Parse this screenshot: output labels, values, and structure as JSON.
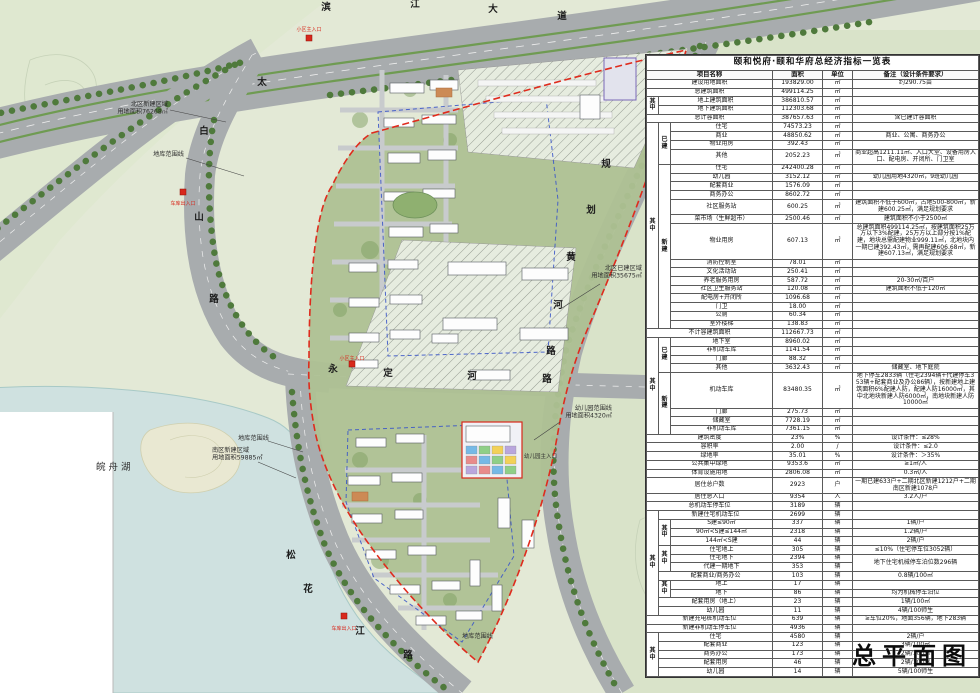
{
  "drawing": {
    "title": "总平面图"
  },
  "table": {
    "title": "颐和悦府·颐和华府总经济指标一览表",
    "headers": {
      "name": "项目名称",
      "area": "面积",
      "unit": "单位",
      "note": "备注（设计条件要求）"
    },
    "rows": [
      {
        "n": "建设用地面积",
        "ns": 3,
        "v": "193829.00",
        "u": "㎡",
        "t": "约290.75亩"
      },
      {
        "n": "总建筑面积",
        "ns": 3,
        "v": "499114.25",
        "u": "㎡",
        "t": ""
      },
      {
        "a": "其中",
        "ar": 2,
        "n": "地上建筑面积",
        "ns": 2,
        "v": "386810.57",
        "u": "㎡",
        "t": ""
      },
      {
        "n": "地下建筑面积",
        "ns": 2,
        "v": "112303.68",
        "u": "㎡",
        "t": ""
      },
      {
        "n": "总计容面积",
        "ns": 3,
        "v": "387657.63",
        "u": "㎡",
        "t": "含已建计容面积"
      },
      {
        "a": "其中",
        "ar": 19,
        "b": "已建",
        "br": 4,
        "n": "住宅",
        "v": "74573.23",
        "u": "㎡",
        "t": ""
      },
      {
        "n": "商业",
        "v": "48850.62",
        "u": "㎡",
        "t": "商业、公寓、商务办公"
      },
      {
        "n": "物业用房",
        "v": "392.43",
        "u": "㎡",
        "t": ""
      },
      {
        "n": "其他",
        "v": "2052.23",
        "u": "㎡",
        "t": "商业超高1211.11㎡、入口大堂、设备用房入口、配电房、开闭所、门卫室"
      },
      {
        "b": "新建",
        "br": 15,
        "n": "住宅",
        "v": "242400.28",
        "u": "㎡",
        "t": ""
      },
      {
        "n": "幼儿园",
        "v": "3152.12",
        "u": "㎡",
        "t": "幼儿园用地4320㎡，9班幼儿园"
      },
      {
        "n": "配套商业",
        "v": "1576.09",
        "u": "㎡",
        "t": ""
      },
      {
        "n": "商务办公",
        "v": "8602.72",
        "u": "㎡",
        "t": ""
      },
      {
        "n": "社区服务站",
        "v": "600.25",
        "u": "㎡",
        "t": "建筑面积不低于600㎡，占地500-800㎡，新建600.25㎡，满足规划要求"
      },
      {
        "n": "菜市场（生鲜超市）",
        "v": "2500.46",
        "u": "㎡",
        "t": "建筑面积不小于2500㎡"
      },
      {
        "n": "物业用房",
        "v": "607.13",
        "u": "㎡",
        "t": "总建筑面积499114.25㎡，按建筑面积25万方以下3%配建，25万方以上部分按1%配建，地块总需配建物业999.11㎡，北地块内一期已建392.43㎡，需再配建606.68㎡，新建607.13㎡，满足规划要求"
      },
      {
        "n": "消防控制室",
        "v": "78.01",
        "u": "㎡",
        "t": ""
      },
      {
        "n": "文化活动站",
        "v": "250.41",
        "u": "㎡",
        "t": ""
      },
      {
        "n": "养老服务用房",
        "v": "587.72",
        "u": "㎡",
        "t": "20-30㎡/百户"
      },
      {
        "n": "社区卫生服务站",
        "v": "120.08",
        "u": "㎡",
        "t": "建筑面积不低于120㎡"
      },
      {
        "n": "配电房+开闭所",
        "v": "1096.68",
        "u": "㎡",
        "t": ""
      },
      {
        "n": "门卫",
        "v": "18.00",
        "u": "㎡",
        "t": ""
      },
      {
        "n": "公厕",
        "v": "60.34",
        "u": "㎡",
        "t": ""
      },
      {
        "n": "室外楼梯",
        "v": "138.83",
        "u": "㎡",
        "t": ""
      },
      {
        "n": "不计容建筑面积",
        "ns": 3,
        "v": "112667.73",
        "u": "㎡",
        "t": ""
      },
      {
        "a": "其中",
        "ar": 8,
        "b": "已建",
        "br": 4,
        "n": "地下室",
        "v": "8960.02",
        "u": "㎡",
        "t": ""
      },
      {
        "n": "非机动车库",
        "v": "1141.54",
        "u": "㎡",
        "t": ""
      },
      {
        "n": "门廊",
        "v": "88.32",
        "u": "㎡",
        "t": ""
      },
      {
        "n": "其他",
        "v": "3632.43",
        "u": "㎡",
        "t": "储藏室、地下庭院"
      },
      {
        "b": "新建",
        "br": 4,
        "n": "机动车库",
        "v": "83480.35",
        "u": "㎡",
        "t": "地下停车2833辆（住宅2394辆+代建停车353辆+配套商业及办公86辆），按新建地上建筑面积6%配建人防，配建人防16000㎡，其中北地块新建人防6000㎡，南地块新建人防10000㎡"
      },
      {
        "n": "门廊",
        "v": "275.73",
        "u": "㎡",
        "t": ""
      },
      {
        "n": "储藏室",
        "v": "7728.19",
        "u": "㎡",
        "t": ""
      },
      {
        "n": "非机动车库",
        "v": "7361.15",
        "u": "㎡",
        "t": ""
      },
      {
        "n": "建筑密度",
        "ns": 3,
        "v": "23%",
        "u": "%",
        "t": "设计条件：≤28%"
      },
      {
        "n": "容积率",
        "ns": 3,
        "v": "2.00",
        "u": "/",
        "t": "设计条件：≤2.0"
      },
      {
        "n": "绿地率",
        "ns": 3,
        "v": "35.01",
        "u": "%",
        "t": "设计条件：＞35%"
      },
      {
        "n": "公共集中绿地",
        "ns": 3,
        "v": "9353.6",
        "u": "㎡",
        "t": "≥1㎡/人"
      },
      {
        "n": "体育设施用地",
        "ns": 3,
        "v": "2806.08",
        "u": "㎡",
        "t": "0.3㎡/人"
      },
      {
        "n": "居住总户数",
        "ns": 3,
        "v": "2923",
        "u": "户",
        "t": "一期已建633户+二期北区新建1212户+二期南区新建1078户"
      },
      {
        "n": "居住总人口",
        "ns": 3,
        "v": "9354",
        "u": "人",
        "t": "3.2人/户"
      },
      {
        "n": "总机动车停车位",
        "ns": 3,
        "v": "3189",
        "u": "辆",
        "t": ""
      },
      {
        "a": "其中",
        "ar": 12,
        "n": "新建住宅机动车位",
        "ns": 2,
        "v": "2699",
        "u": "辆",
        "t": ""
      },
      {
        "b": "其中",
        "br": 3,
        "n": "S建≤90㎡",
        "v": "337",
        "u": "辆",
        "t": "1辆/户"
      },
      {
        "n": "90㎡<S建≤144㎡",
        "v": "2318",
        "u": "辆",
        "t": "1.2辆/户"
      },
      {
        "n": "144㎡<S建",
        "v": "44",
        "u": "辆",
        "t": "2辆/户"
      },
      {
        "b": "其中",
        "br": 3,
        "n": "住宅地上",
        "v": "305",
        "u": "辆",
        "t": "≤10%（住宅停车位3052辆）"
      },
      {
        "n": "住宅地下",
        "v": "2394",
        "u": "辆",
        "t": "地下住宅机械停车泊位数296辆",
        "tr": 2
      },
      {
        "n": "代建一期地下",
        "v": "353",
        "u": "辆"
      },
      {
        "n": "配套商业/商务办公",
        "ns": 2,
        "v": "103",
        "u": "辆",
        "t": "0.8辆/100㎡"
      },
      {
        "b": "其中",
        "br": 2,
        "n": "地上",
        "v": "17",
        "u": "辆",
        "t": ""
      },
      {
        "n": "地下",
        "v": "86",
        "u": "辆",
        "t": "均为机械停车泊位"
      },
      {
        "n": "配套用房（地上）",
        "ns": 2,
        "v": "23",
        "u": "辆",
        "t": "1辆/100㎡"
      },
      {
        "n": "幼儿园",
        "ns": 2,
        "v": "11",
        "u": "辆",
        "t": "4辆/100师生"
      },
      {
        "n": "新建充电桩机动车位",
        "ns": 3,
        "v": "639",
        "u": "辆",
        "t": "≥车位20%，地面356辆，地下283辆"
      },
      {
        "n": "新建非机动车停车位",
        "ns": 3,
        "v": "4936",
        "u": "辆",
        "t": ""
      },
      {
        "a": "其中",
        "ar": 5,
        "n": "住宅",
        "ns": 2,
        "v": "4580",
        "u": "辆",
        "t": "2辆/户"
      },
      {
        "n": "配套商业",
        "ns": 2,
        "v": "123",
        "u": "辆",
        "t": "3辆/100㎡"
      },
      {
        "n": "商务办公",
        "ns": 2,
        "v": "173",
        "u": "辆",
        "t": "2辆/100㎡"
      },
      {
        "n": "配套用房",
        "ns": 2,
        "v": "46",
        "u": "辆",
        "t": "2辆/100㎡"
      },
      {
        "n": "幼儿园",
        "ns": 2,
        "v": "14",
        "u": "辆",
        "t": "5辆/100师生"
      }
    ]
  },
  "map": {
    "roads": [
      {
        "id": "binjiang",
        "name": "滨江大道"
      },
      {
        "id": "taibaishan",
        "name": "太白山路"
      },
      {
        "id": "yongdinghe",
        "name": "永定河路"
      },
      {
        "id": "guihuanghe",
        "name": "规划黄河路"
      },
      {
        "id": "songhuajiang",
        "name": "松花江路"
      }
    ],
    "area_labels": [
      {
        "id": "north_new",
        "lines": [
          "北区新建区域",
          "用地面积76268㎡"
        ]
      },
      {
        "id": "garage_line_n",
        "lines": [
          "地库范围线"
        ]
      },
      {
        "id": "north_built",
        "lines": [
          "北区已建区域",
          "用地面积35675㎡"
        ]
      },
      {
        "id": "south_new",
        "lines": [
          "南区新建区域",
          "用地面积59885㎡"
        ]
      },
      {
        "id": "garage_line_s",
        "lines": [
          "地库范围线"
        ]
      },
      {
        "id": "garage_line_s2",
        "lines": [
          "地库范围线"
        ]
      },
      {
        "id": "kg_line",
        "lines": [
          "幼儿园范围线",
          "用地面积4320㎡"
        ]
      },
      {
        "id": "kg_entrance",
        "lines": [
          "幼儿园主入口"
        ]
      },
      {
        "id": "lake_name",
        "lines": [
          "皖舟湖"
        ]
      }
    ],
    "markers": [
      {
        "id": "entrance_top",
        "label": "小区主入口"
      },
      {
        "id": "garage_entry_west",
        "label": "车库出入口"
      },
      {
        "id": "entrance_main",
        "label": "小区主入口"
      },
      {
        "id": "garage_entry_south",
        "label": "车库出入口"
      }
    ]
  }
}
